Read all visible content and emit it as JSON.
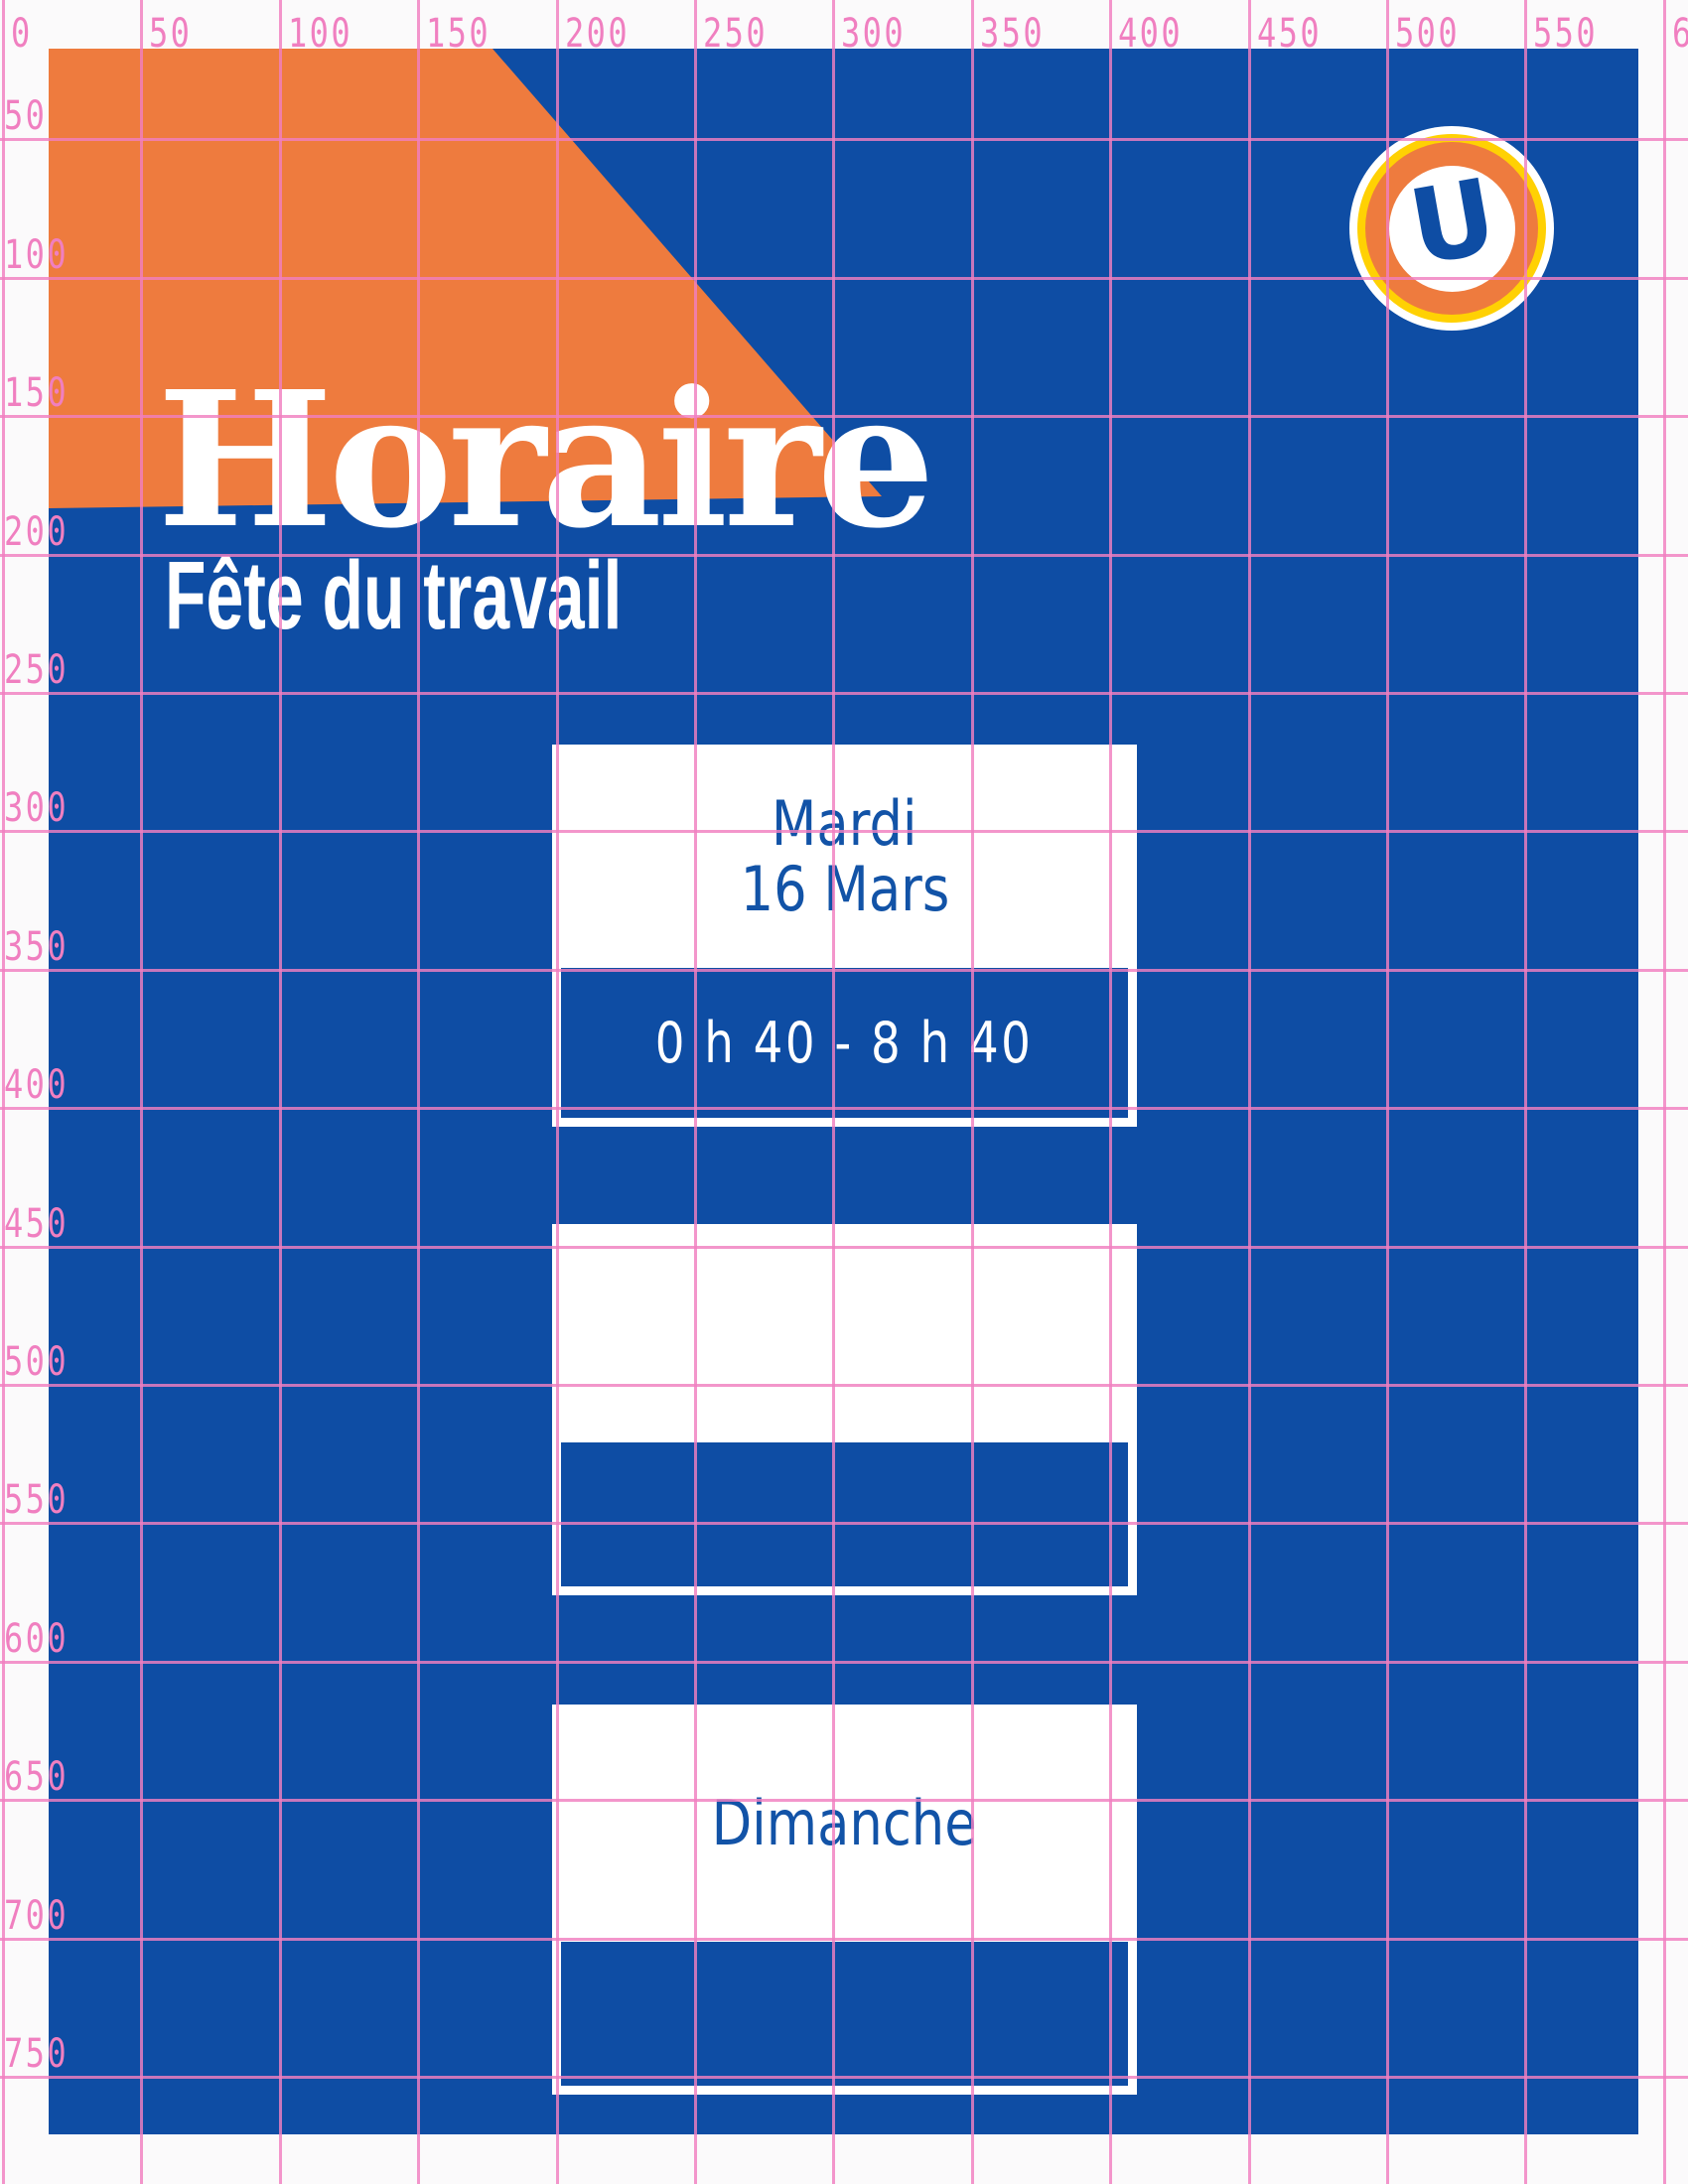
{
  "poster": {
    "title": "Horaire",
    "subtitle": "Fête du travail",
    "logo": {
      "letter": "U"
    },
    "cards": [
      {
        "day": "Mardi",
        "date": "16 Mars",
        "time": "0 h 40 - 8 h 40"
      },
      {
        "day": "",
        "date": "",
        "time": ""
      },
      {
        "day": "Dimanche",
        "date": "",
        "time": ""
      }
    ],
    "colors": {
      "blue": "#0E4DA4",
      "orange": "#EE7B3E",
      "yellow": "#FFD103",
      "pink": "#F07FC0",
      "card_text_blue": "#1253A7"
    }
  },
  "grid": {
    "pitch": 139.4,
    "top_labels": [
      "0",
      "50",
      "100",
      "150",
      "200",
      "250",
      "300",
      "350",
      "400",
      "450",
      "500",
      "550",
      "600"
    ],
    "left_labels": [
      "50",
      "100",
      "150",
      "200",
      "250",
      "300",
      "350",
      "400",
      "450",
      "500",
      "550",
      "600",
      "650",
      "700",
      "750"
    ]
  }
}
